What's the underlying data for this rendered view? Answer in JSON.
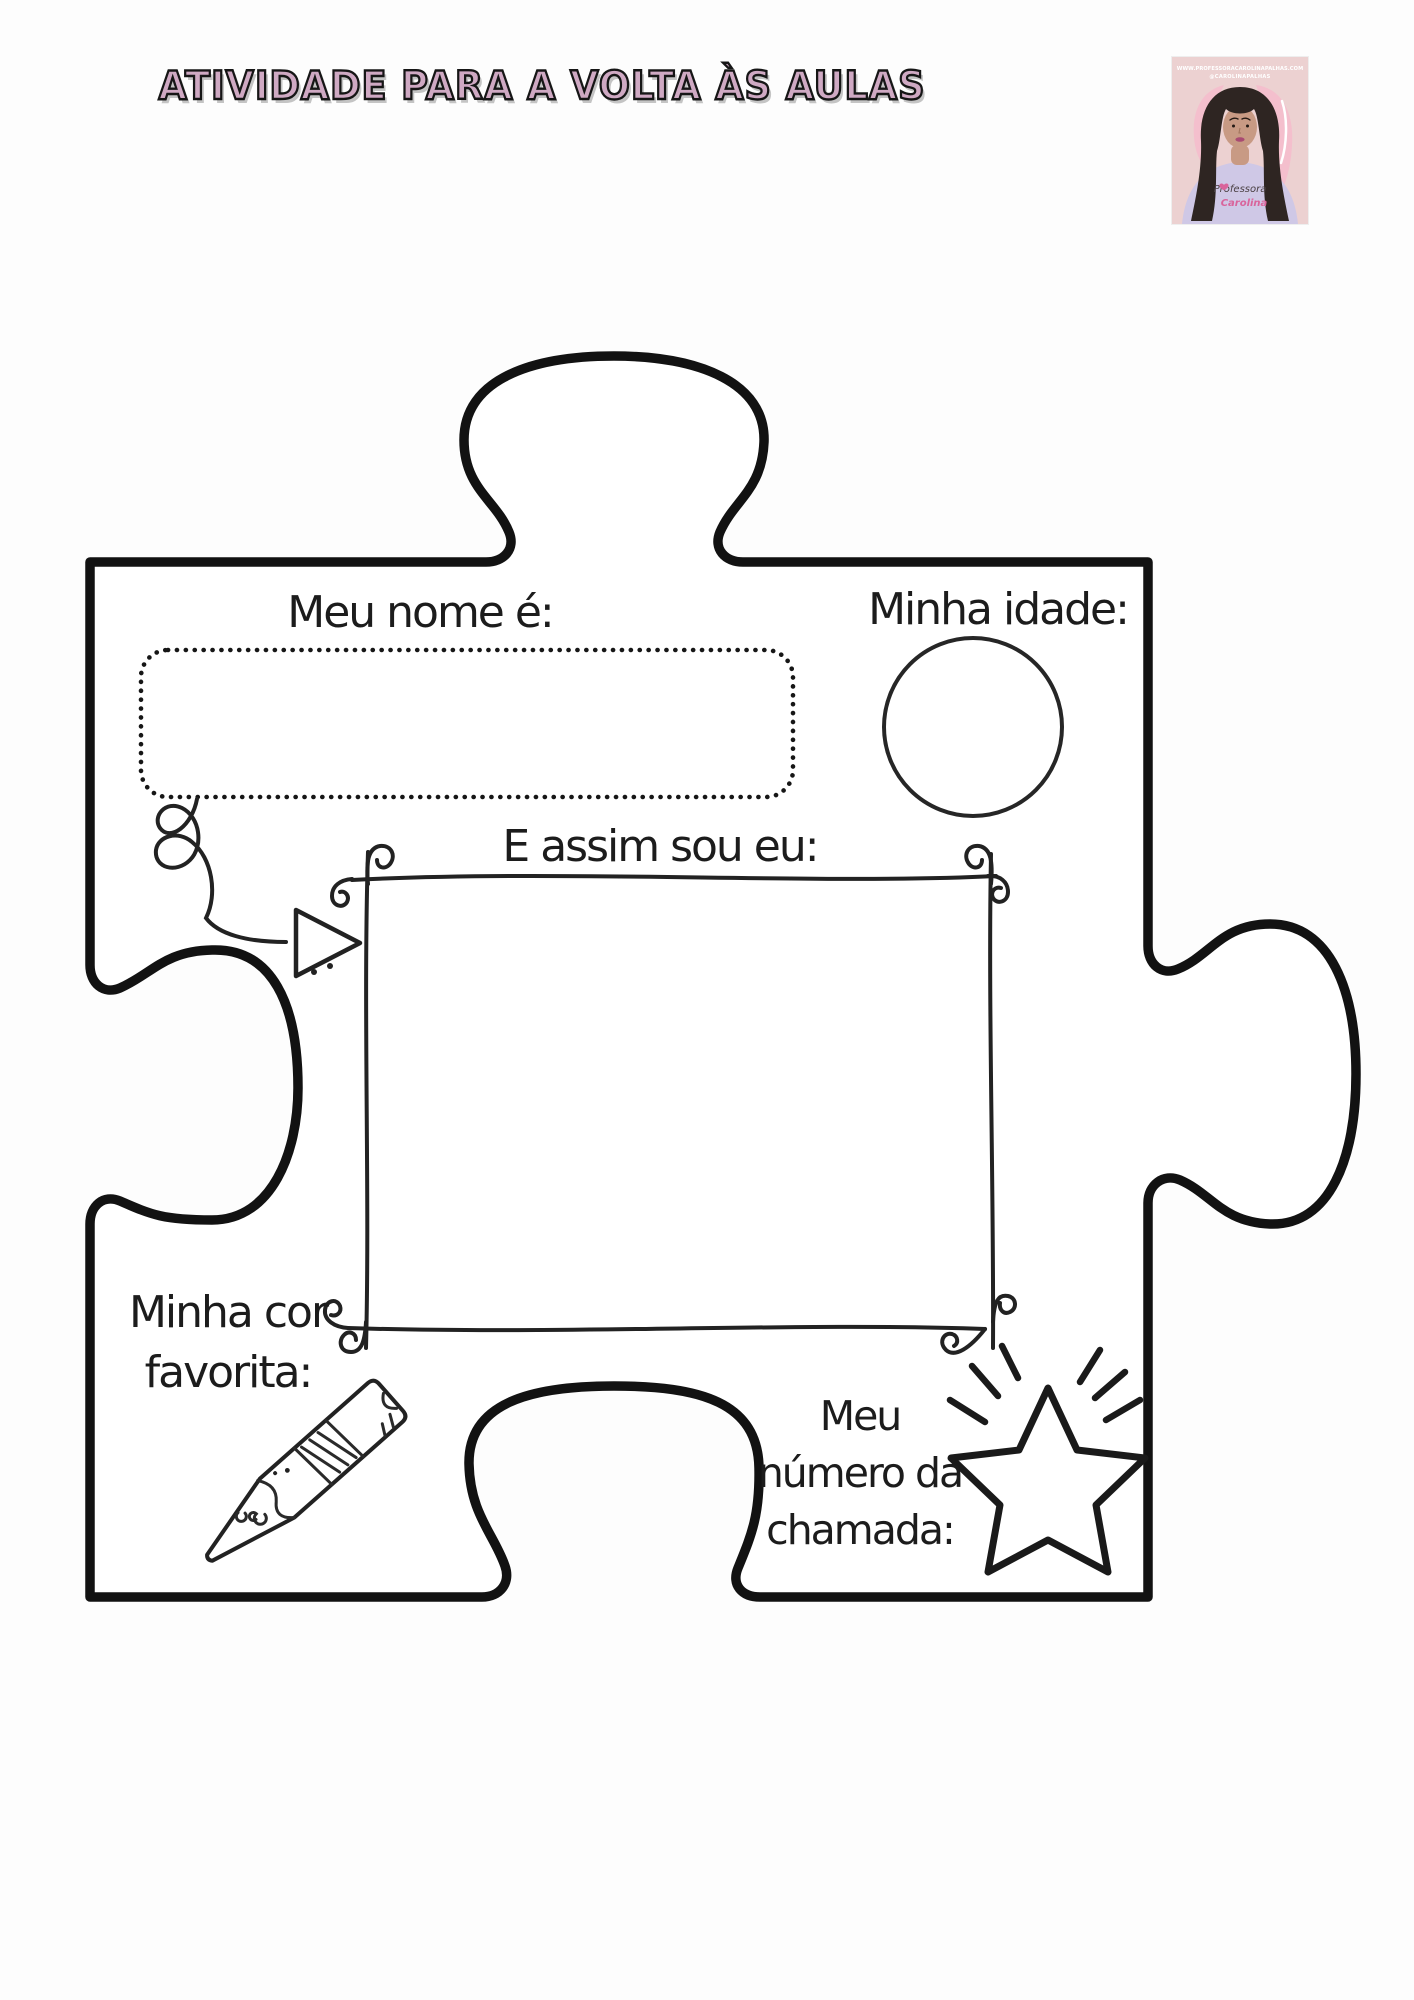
{
  "page": {
    "title": "ATIVIDADE PARA A VOLTA ÀS AULAS"
  },
  "branding": {
    "website": "WWW.PROFESSORACAROLINAPALHAS.COM",
    "handle": "@CAROLINAPALHAS",
    "shirt_line1": "Professora",
    "shirt_line2": "Carolina"
  },
  "worksheet": {
    "fields": {
      "name": {
        "label": "Meu nome é:",
        "value": ""
      },
      "age": {
        "label": "Minha idade:",
        "value": ""
      },
      "self_portrait": {
        "label": "E assim sou eu:",
        "value": ""
      },
      "favorite_color": {
        "label": "Minha cor favorita:",
        "line1": "Minha cor",
        "line2": "favorita:",
        "value": ""
      },
      "roll_number": {
        "label": "Meu número da chamada:",
        "line1": "Meu",
        "line2": "número da",
        "line3": "chamada:",
        "value": ""
      }
    },
    "icons": [
      "curly-arrow",
      "pencil",
      "star"
    ]
  },
  "colors": {
    "title_pink": "#cfa9c3",
    "title_outline": "#161616",
    "ink": "#1c1c1c",
    "photo_bg": "#ecd1d1",
    "photo_chair": "#f4bfcd",
    "photo_shirt": "#cfc8e6",
    "photo_skin": "#c89a84",
    "photo_hair": "#2e2522",
    "shirt_text_pink": "#d9649b"
  }
}
